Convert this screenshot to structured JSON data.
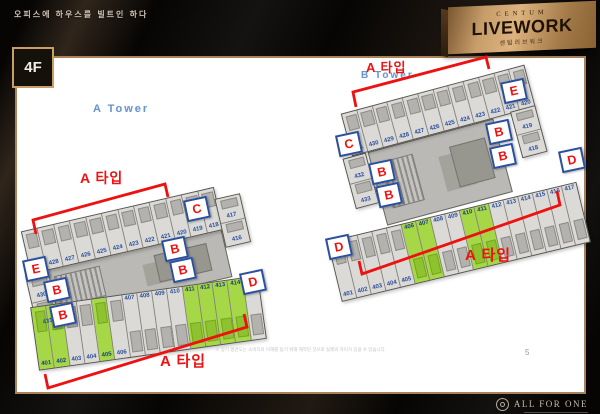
{
  "slide": {
    "slogan": "오피스에 하우스를 빌트인 하다",
    "floor_label": "4F",
    "page_number": "5",
    "disclaimer": "※ 상기 평면도는 소비자의 이해를 돕기 위해 제작된 것으로 실제와 차이가 있을 수 있습니다."
  },
  "logo": {
    "brand_top": "CENTUM",
    "brand_main": "LIVEWORK",
    "brand_sub": "센텀리브워크"
  },
  "footer": {
    "brand": "ALL FOR ONE"
  },
  "colors": {
    "accent_red": "#ee1111",
    "unit_green": "#a6d747",
    "unit_number_blue": "#2a4f9f",
    "marker_border_blue": "#2b4f9e",
    "gold": "#c79e6a"
  },
  "plans": [
    {
      "tower_label": "A Tower",
      "type_label": "A 타입",
      "top_row": [
        "429",
        "428",
        "427",
        "426",
        "425",
        "424",
        "423",
        "422",
        "421",
        "420",
        "419",
        "418"
      ],
      "right_col": [
        "417",
        "416"
      ],
      "left_col": [
        "430",
        "431"
      ],
      "bottom_row": [
        "401",
        "402",
        "403",
        "404",
        "405",
        "406",
        "407",
        "408",
        "409",
        "410",
        "411",
        "412",
        "413",
        "414",
        "415"
      ],
      "green_units": [
        "401",
        "402",
        "405",
        "411",
        "412",
        "413",
        "414"
      ],
      "markers": [
        "E",
        "B",
        "B",
        "B",
        "B",
        "C",
        "D"
      ]
    },
    {
      "tower_label": "B Tower",
      "type_label": "A 타입",
      "top_row": [
        "431",
        "430",
        "429",
        "428",
        "427",
        "426",
        "425",
        "424",
        "423",
        "422",
        "421",
        "420"
      ],
      "right_col": [
        "419",
        "418"
      ],
      "left_col": [
        "432",
        "433"
      ],
      "bottom_row": [
        "401",
        "402",
        "403",
        "404",
        "405",
        "406",
        "407",
        "408",
        "409",
        "410",
        "411",
        "412",
        "413",
        "414",
        "415",
        "416",
        "417"
      ],
      "green_units": [
        "406",
        "407",
        "410",
        "411"
      ],
      "markers": [
        "C",
        "E",
        "B",
        "B",
        "B",
        "B",
        "D",
        "D"
      ]
    }
  ]
}
